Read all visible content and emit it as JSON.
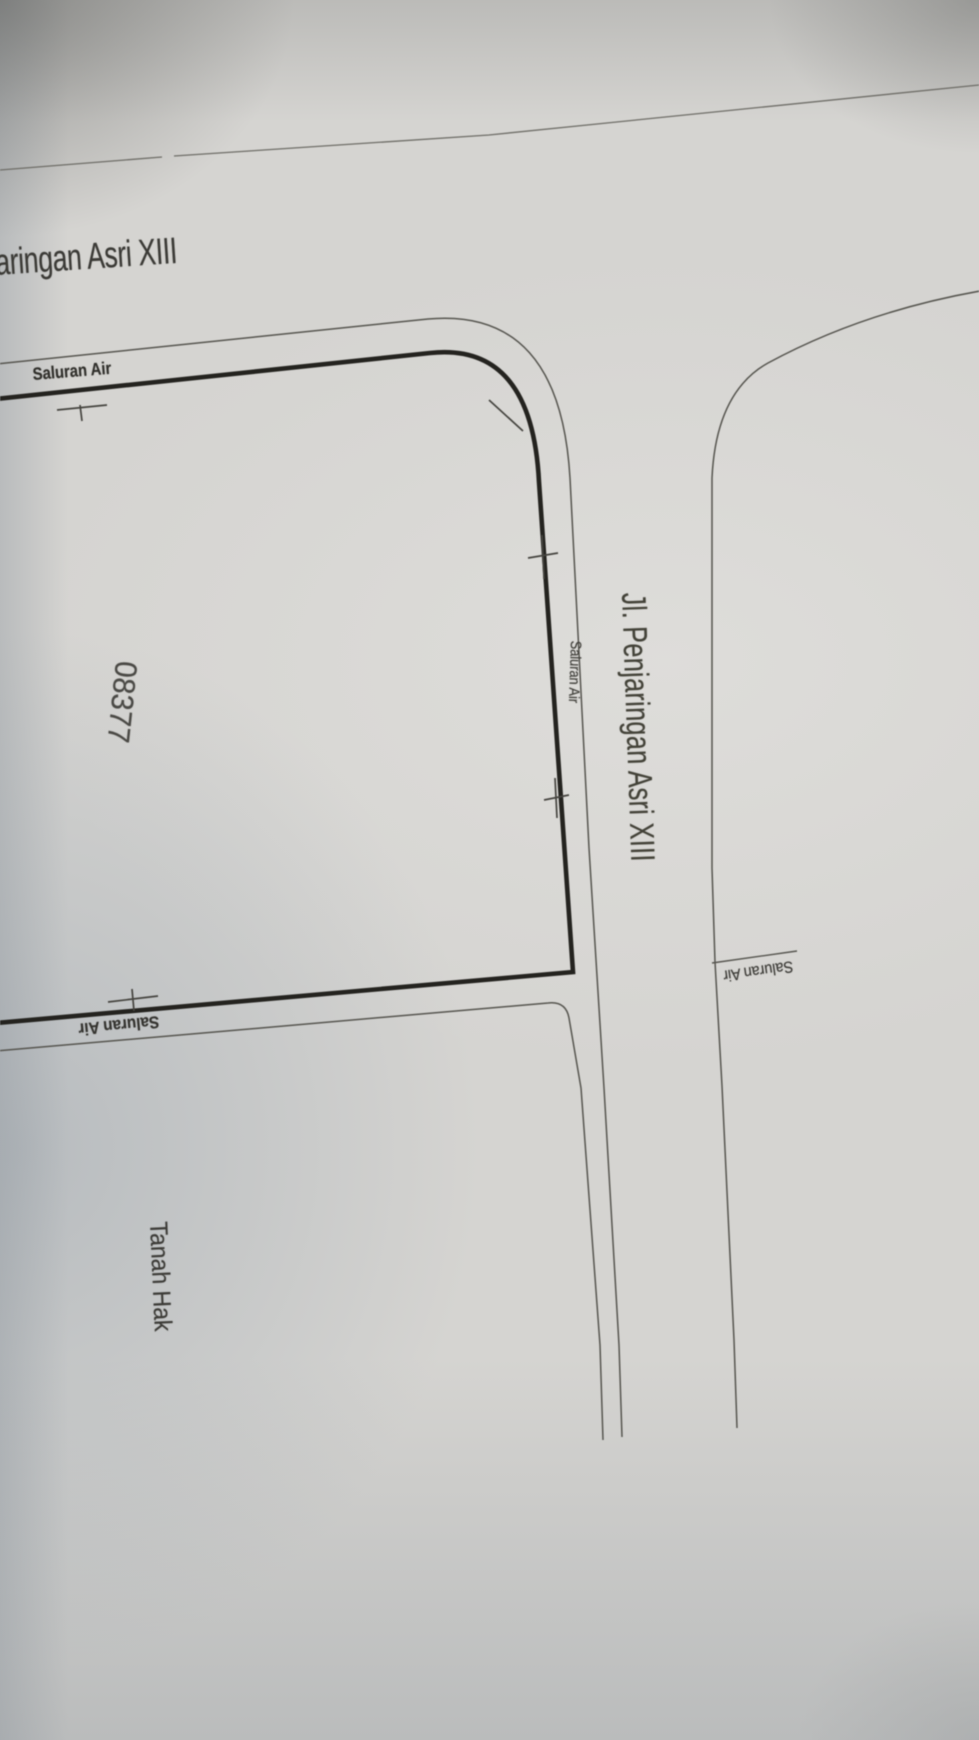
{
  "photo": {
    "labels": {
      "street_top_partial": "aringan Asri XIII",
      "drain_top": "Saluran Air",
      "drain_east": "Saluran Air",
      "drain_right": "Saluran Air",
      "drain_bottom": "Saluran Air",
      "parcel_number": "08377",
      "road_name": "Jl. Penjaringan Asri XIII",
      "land_status": "Tanah Hak"
    },
    "colors": {
      "paper": "#d5d4d1",
      "ink_thick": "#24231f",
      "ink_thin": "#56554f",
      "neighbor_line": "#6e6d67",
      "text": "#3a3935",
      "shadow_blue": "#97a1ab"
    }
  }
}
